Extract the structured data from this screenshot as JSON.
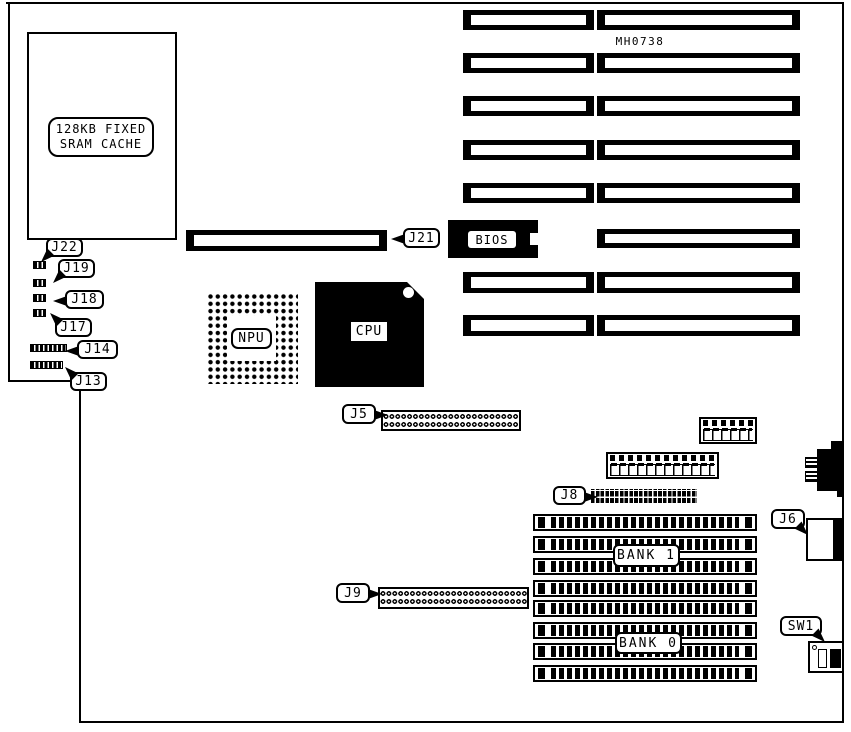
{
  "diagram": {
    "model": "MH0738",
    "cache": {
      "line1": "128KB FIXED",
      "line2": "SRAM CACHE"
    },
    "chips": {
      "bios": "BIOS",
      "npu": "NPU",
      "cpu": "CPU"
    },
    "banks": {
      "bank1": "BANK 1",
      "bank0": "BANK 0"
    },
    "callouts": {
      "j22": "J22",
      "j19": "J19",
      "j18": "J18",
      "j17": "J17",
      "j14": "J14",
      "j13": "J13",
      "j21": "J21",
      "j5": "J5",
      "j8": "J8",
      "j9": "J9",
      "j6": "J6",
      "sw1": "SW1"
    },
    "colors": {
      "ink": "#000000",
      "paper": "#ffffff"
    }
  }
}
